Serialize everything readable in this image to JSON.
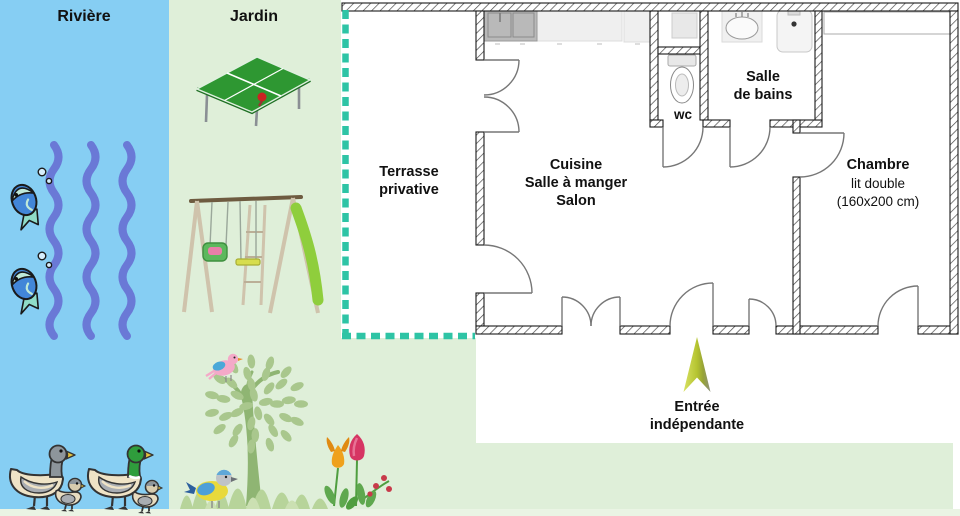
{
  "scene": {
    "river": {
      "title": "Rivière"
    },
    "garden": {
      "title": "Jardin"
    },
    "floorplan": {
      "terrace": {
        "line1": "Terrasse",
        "line2": "privative"
      },
      "living": {
        "line1": "Cuisine",
        "line2": "Salle à manger",
        "line3": "Salon"
      },
      "wc": {
        "label": "wc"
      },
      "bathroom": {
        "line1": "Salle",
        "line2": "de bains"
      },
      "bedroom": {
        "title": "Chambre",
        "line2": "lit double",
        "line3": "(160x200 cm)"
      },
      "entrance": {
        "line1": "Entrée",
        "line2": "indépendante"
      }
    },
    "colors": {
      "river_bg": "#86CEF3",
      "garden_bg": "#DFEFD9",
      "bottom_strip": "#EAF4E4",
      "terrace_dash": "#2EC4A5",
      "wave_blue": "#6A79D6",
      "entry_arrow_green": "#B5C430",
      "wall_outline": "#1A1A1A",
      "label_text": "#111111"
    }
  }
}
